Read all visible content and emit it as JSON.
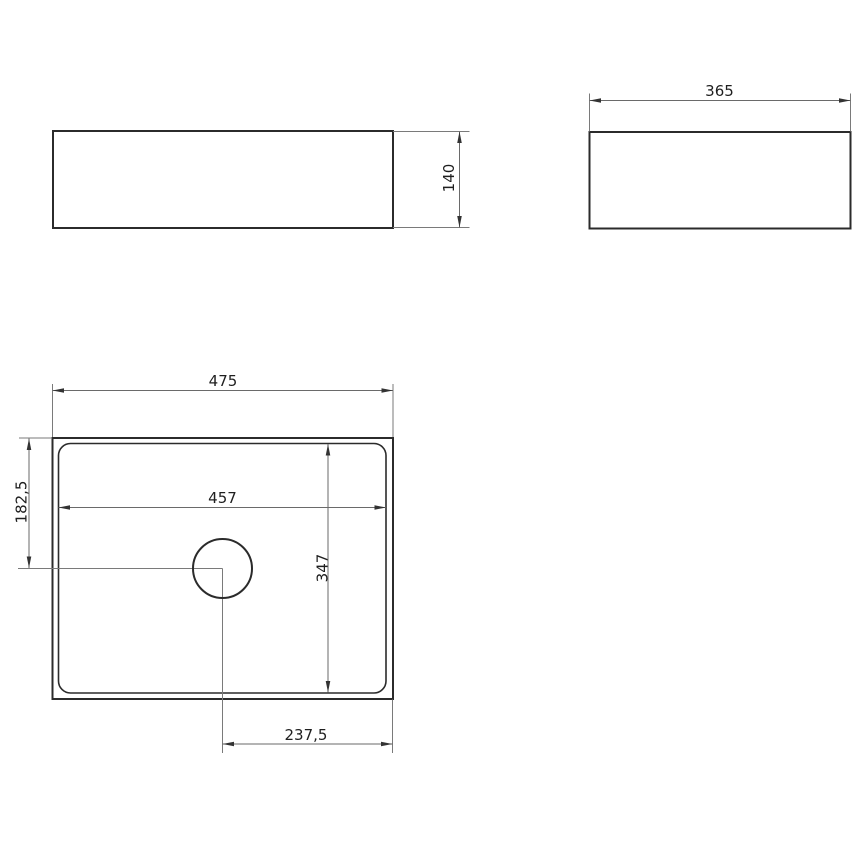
{
  "drawing": {
    "background": "#ffffff",
    "outline_color": "#2b2b2b",
    "dimension_line_color": "#6a6a6a",
    "text_color": "#1f1f1f",
    "views": {
      "front": {
        "height": "140"
      },
      "side": {
        "width": "365"
      },
      "plan": {
        "overall_width": "475",
        "inner_width": "457",
        "drain_offset_side": "182,5",
        "inner_depth": "347",
        "drain_offset_bottom": "237,5"
      }
    }
  }
}
